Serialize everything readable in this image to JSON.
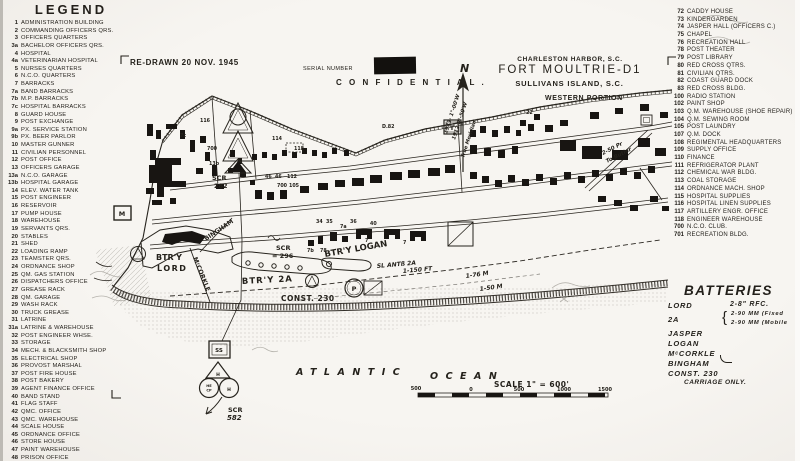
{
  "title_block": {
    "line1": "CHARLESTON HARBOR, S.C.",
    "line2": "FORT MOULTRIE-D1",
    "line3": "SULLIVANS ISLAND, S.C.",
    "line4": "WESTERN PORTION"
  },
  "annotations": {
    "redrawn": "RE-DRAWN 20 NOV. 1945",
    "serial": "SERIAL NUMBER",
    "confidential": "C O N F I D E N T I A L ."
  },
  "legend_left": {
    "title": "LEGEND",
    "items": [
      {
        "n": "1",
        "t": "ADMINISTRATION BUILDING"
      },
      {
        "n": "2",
        "t": "COMMANDING OFFICERS QRS."
      },
      {
        "n": "3",
        "t": "OFFICERS QUARTERS"
      },
      {
        "n": "3a",
        "t": "BACHELOR OFFICERS QRS."
      },
      {
        "n": "4",
        "t": "HOSPITAL"
      },
      {
        "n": "4a",
        "t": "VETERINARIAN HOSPITAL"
      },
      {
        "n": "5",
        "t": "NURSES QUARTERS"
      },
      {
        "n": "6",
        "t": "N.C.O. QUARTERS"
      },
      {
        "n": "7",
        "t": "BARRACKS"
      },
      {
        "n": "7a",
        "t": "BAND BARRACKS"
      },
      {
        "n": "7b",
        "t": "M.P. BARRACKS"
      },
      {
        "n": "7c",
        "t": "HOSPITAL BARRACKS"
      },
      {
        "n": "8",
        "t": "GUARD HOUSE"
      },
      {
        "n": "9",
        "t": "POST EXCHANGE"
      },
      {
        "n": "9a",
        "t": "PX. SERVICE STATION"
      },
      {
        "n": "9b",
        "t": "PX. BEER PARLOR"
      },
      {
        "n": "10",
        "t": "MASTER GUNNER"
      },
      {
        "n": "11",
        "t": "CIVILIAN PERSONNEL"
      },
      {
        "n": "12",
        "t": "POST OFFICE"
      },
      {
        "n": "13",
        "t": "OFFICERS GARAGE"
      },
      {
        "n": "13a",
        "t": "N.C.O. GARAGE"
      },
      {
        "n": "13b",
        "t": "HOSPITAL GARAGE"
      },
      {
        "n": "14",
        "t": "ELEV. WATER TANK"
      },
      {
        "n": "15",
        "t": "POST ENGINEER"
      },
      {
        "n": "16",
        "t": "RESERVOIR"
      },
      {
        "n": "17",
        "t": "PUMP HOUSE"
      },
      {
        "n": "18",
        "t": "WAREHOUSE"
      },
      {
        "n": "19",
        "t": "SERVANTS QRS."
      },
      {
        "n": "20",
        "t": "STABLES"
      },
      {
        "n": "21",
        "t": "SHED"
      },
      {
        "n": "22",
        "t": "LOADING RAMP"
      },
      {
        "n": "23",
        "t": "TEAMSTER QRS."
      },
      {
        "n": "24",
        "t": "ORDNANCE SHOP"
      },
      {
        "n": "25",
        "t": "QM. GAS STATION"
      },
      {
        "n": "26",
        "t": "DISPATCHERS OFFICE"
      },
      {
        "n": "27",
        "t": "GREASE RACK"
      },
      {
        "n": "28",
        "t": "QM. GARAGE"
      },
      {
        "n": "29",
        "t": "WASH RACK"
      },
      {
        "n": "30",
        "t": "TRUCK GREASE"
      },
      {
        "n": "31",
        "t": "LATRINE"
      },
      {
        "n": "31a",
        "t": "LATRINE & WAREHOUSE"
      },
      {
        "n": "32",
        "t": "POST ENGINEER WHSE."
      },
      {
        "n": "33",
        "t": "STORAGE"
      },
      {
        "n": "34",
        "t": "MECH. & BLACKSMITH SHOP"
      },
      {
        "n": "35",
        "t": "ELECTRICAL SHOP"
      },
      {
        "n": "36",
        "t": "PROVOST MARSHAL"
      },
      {
        "n": "37",
        "t": "POST FIRE HOUSE"
      },
      {
        "n": "38",
        "t": "POST BAKERY"
      },
      {
        "n": "39",
        "t": "AGENT FINANCE OFFICE"
      },
      {
        "n": "40",
        "t": "BAND STAND"
      },
      {
        "n": "41",
        "t": "FLAG STAFF"
      },
      {
        "n": "42",
        "t": "QMC. OFFICE"
      },
      {
        "n": "43",
        "t": "QMC. WAREHOUSE"
      },
      {
        "n": "44",
        "t": "SCALE HOUSE"
      },
      {
        "n": "45",
        "t": "ORDNANCE OFFICE"
      },
      {
        "n": "46",
        "t": "STORE HOUSE"
      },
      {
        "n": "47",
        "t": "PAINT WAREHOUSE"
      },
      {
        "n": "48",
        "t": "PRISON OFFICE"
      },
      {
        "n": "49",
        "t": "TOOL SHED"
      }
    ]
  },
  "legend_right": {
    "items": [
      {
        "n": "72",
        "t": "CADDY HOUSE"
      },
      {
        "n": "73",
        "t": "KINDERGARDEN"
      },
      {
        "n": "74",
        "t": "JASPER HALL (OFFICERS C.)"
      },
      {
        "n": "75",
        "t": "CHAPEL"
      },
      {
        "n": "76",
        "t": "RECREATION HALL"
      },
      {
        "n": "78",
        "t": "POST THEATER"
      },
      {
        "n": "79",
        "t": "POST LIBRARY"
      },
      {
        "n": "80",
        "t": "RED CROSS QTRS."
      },
      {
        "n": "81",
        "t": "CIVILIAN QTRS."
      },
      {
        "n": "82",
        "t": "COAST GUARD DOCK"
      },
      {
        "n": "83",
        "t": "RED CROSS BLDG."
      },
      {
        "n": "100",
        "t": "RADIO STATION"
      },
      {
        "n": "102",
        "t": "PAINT SHOP"
      },
      {
        "n": "103",
        "t": "Q.M. WAREHOUSE (SHOE REPAIR)"
      },
      {
        "n": "104",
        "t": "Q.M. SEWING ROOM"
      },
      {
        "n": "105",
        "t": "POST LAUNDRY"
      },
      {
        "n": "107",
        "t": "Q.M. DOCK"
      },
      {
        "n": "108",
        "t": "REGIMENTAL HEADQUARTERS"
      },
      {
        "n": "109",
        "t": "SUPPLY OFFICE"
      },
      {
        "n": "110",
        "t": "FINANCE"
      },
      {
        "n": "111",
        "t": "REFRIGERATOR PLANT"
      },
      {
        "n": "112",
        "t": "CHEMICAL WAR BLDG."
      },
      {
        "n": "113",
        "t": "COAL STORAGE"
      },
      {
        "n": "114",
        "t": "ORDNANCE MACH. SHOP"
      },
      {
        "n": "115",
        "t": "HOSPITAL SUPPLIES"
      },
      {
        "n": "116",
        "t": "HOSPITAL LINEN SUPPLIES"
      },
      {
        "n": "117",
        "t": "ARTILLERY ENGR. OFFICE"
      },
      {
        "n": "118",
        "t": "ENGINEER WAREHOUSE"
      },
      {
        "n": "700",
        "t": "N.C.O. CLUB."
      },
      {
        "n": "701",
        "t": "RECREATION BLDG."
      }
    ]
  },
  "batteries": {
    "title": "BATTERIES",
    "lord_name": "LORD",
    "lord_arm": "2-8\" RFC.",
    "b2a_name": "2A",
    "b2a_brace": "{",
    "b2a_arm1": "2-90 MM (Fixed",
    "b2a_arm2": "2-90 MM (Mobile",
    "others": [
      "JASPER",
      "LOGAN",
      "MᶜCORKLE",
      "BINGHAM",
      "CONST. 230"
    ],
    "carriage_note": "CARRIAGE ONLY."
  },
  "map": {
    "labels": [
      {
        "nm": "north-letter",
        "t": "N",
        "x": 460,
        "y": 72,
        "s": 11,
        "i": 1
      },
      {
        "nm": "declination-1943",
        "t": "1943· 1°-00'W",
        "x": 447,
        "y": 134,
        "s": 5.2,
        "r": -72,
        "i": 1
      },
      {
        "nm": "declination-1912",
        "t": "1912 0°-50'W",
        "x": 455,
        "y": 140,
        "s": 5.2,
        "r": -72,
        "i": 1
      },
      {
        "nm": "true-meridian",
        "t": "True Meridian.",
        "x": 464,
        "y": 158,
        "s": 5,
        "r": -72,
        "i": 1
      },
      {
        "nm": "scr-282-l1",
        "t": "SCR",
        "x": 212,
        "y": 180,
        "s": 6.5
      },
      {
        "nm": "scr-282-l2",
        "t": "282",
        "x": 214,
        "y": 188,
        "s": 6.5
      },
      {
        "nm": "btry-lord-l1",
        "t": "BTR'Y",
        "x": 156,
        "y": 260,
        "s": 8
      },
      {
        "nm": "btry-lord-l2",
        "t": "LORD",
        "x": 157,
        "y": 271,
        "s": 8,
        "ls": 1.5
      },
      {
        "nm": "road-mccorkle",
        "t": "MᶜCORKLE",
        "x": 193,
        "y": 258,
        "s": 6.2,
        "r": 68
      },
      {
        "nm": "road-bingham",
        "t": "BINGHAM",
        "x": 206,
        "y": 241,
        "s": 6.2,
        "r": -34
      },
      {
        "nm": "scr-296-l1",
        "t": "SCR",
        "x": 276,
        "y": 250,
        "s": 6.5
      },
      {
        "nm": "scr-296-l2",
        "t": "= 296",
        "x": 272,
        "y": 258,
        "s": 6.5
      },
      {
        "nm": "btry-2a-label",
        "t": "BTR'Y 2A",
        "x": 242,
        "y": 284,
        "s": 8.5,
        "ls": 1,
        "r": -3
      },
      {
        "nm": "btry-logan-label",
        "t": "BTR'Y LOGAN",
        "x": 325,
        "y": 257,
        "s": 8.5,
        "r": -10
      },
      {
        "nm": "sl-ant-2a",
        "t": "SL ANTß 2A",
        "x": 377,
        "y": 268,
        "s": 6,
        "i": 1,
        "r": -5
      },
      {
        "nm": "const-230-label",
        "t": "CONST. 230",
        "x": 281,
        "y": 301,
        "s": 7.5,
        "ls": 0.5
      },
      {
        "nm": "dist-150ft",
        "t": "1-150 FT",
        "x": 403,
        "y": 273,
        "s": 6,
        "i": 1,
        "r": -5
      },
      {
        "nm": "dist-76m",
        "t": "1-76 M",
        "x": 466,
        "y": 278,
        "s": 6,
        "i": 1,
        "r": -8
      },
      {
        "nm": "dist-50m",
        "t": "1-50 M",
        "x": 480,
        "y": 291,
        "s": 6,
        "i": 1,
        "r": -8
      },
      {
        "nm": "butler-l1",
        "t": "2-50 Pr",
        "x": 603,
        "y": 155,
        "s": 5.5,
        "i": 1,
        "r": -27
      },
      {
        "nm": "butler-l2",
        "t": "To Butler",
        "x": 607,
        "y": 163,
        "s": 5.5,
        "i": 1,
        "r": -27
      },
      {
        "nm": "scr-582-l1",
        "t": "SCR",
        "x": 228,
        "y": 412,
        "s": 6.5
      },
      {
        "nm": "scr-582-l2",
        "t": "582",
        "x": 227,
        "y": 420,
        "s": 7,
        "i": 1
      },
      {
        "nm": "symbol-m",
        "t": "M",
        "x": 122,
        "y": 216,
        "s": 6.5,
        "a": 1
      },
      {
        "nm": "symbol-t",
        "t": "T",
        "x": 452,
        "y": 130,
        "s": 6.5,
        "a": 1
      },
      {
        "nm": "symbol-p",
        "t": "P",
        "x": 354,
        "y": 291,
        "s": 6.5,
        "a": 1
      },
      {
        "nm": "symbol-ss",
        "t": "SS",
        "x": 219,
        "y": 352,
        "s": 5.5,
        "a": 1
      },
      {
        "nm": "symbol-h-tri",
        "t": "H",
        "x": 218,
        "y": 376,
        "s": 4.5,
        "a": 1
      },
      {
        "nm": "symbol-he",
        "t": "HE",
        "x": 209,
        "y": 387,
        "s": 3.6,
        "a": 1
      },
      {
        "nm": "symbol-cp",
        "t": "CP",
        "x": 209,
        "y": 391.5,
        "s": 3.6,
        "a": 1
      },
      {
        "nm": "symbol-h2",
        "t": "H",
        "x": 229,
        "y": 391,
        "s": 4.5,
        "a": 1
      },
      {
        "nm": "ocean-word-1",
        "t": "ATLANTIC",
        "x": 296,
        "y": 375,
        "s": 9.5,
        "ls": 7.5,
        "i": 1
      },
      {
        "nm": "ocean-word-2",
        "t": "OCEAN",
        "x": 430,
        "y": 379,
        "s": 9.5,
        "ls": 7.5,
        "i": 1
      },
      {
        "nm": "scale-label",
        "t": "SCALE 1\" = 600'",
        "x": 494,
        "y": 387,
        "s": 7.5,
        "ls": 0.5
      },
      {
        "nm": "scale-tick",
        "t": "500",
        "x": 416,
        "y": 390,
        "s": 5,
        "a": 1
      },
      {
        "nm": "scale-tick",
        "t": "0",
        "x": 471,
        "y": 391,
        "s": 5,
        "a": 1
      },
      {
        "nm": "scale-tick",
        "t": "500",
        "x": 519,
        "y": 391,
        "s": 5,
        "a": 1
      },
      {
        "nm": "scale-tick",
        "t": "1000",
        "x": 564,
        "y": 391,
        "s": 5,
        "a": 1
      },
      {
        "nm": "scale-tick",
        "t": "1500",
        "x": 605,
        "y": 391,
        "s": 5,
        "a": 1
      }
    ],
    "markers": [
      {
        "t": "116",
        "x": 200,
        "y": 122
      },
      {
        "t": "7c",
        "x": 180,
        "y": 137
      },
      {
        "t": "700",
        "x": 207,
        "y": 150
      },
      {
        "t": "13b",
        "x": 209,
        "y": 165
      },
      {
        "t": "114",
        "x": 272,
        "y": 140
      },
      {
        "t": "118",
        "x": 294,
        "y": 150
      },
      {
        "t": "46",
        "x": 265,
        "y": 178
      },
      {
        "t": "46",
        "x": 275,
        "y": 178
      },
      {
        "t": "112",
        "x": 287,
        "y": 178
      },
      {
        "t": "700",
        "x": 277,
        "y": 187
      },
      {
        "t": "105",
        "x": 289,
        "y": 187
      },
      {
        "t": "34",
        "x": 316,
        "y": 223
      },
      {
        "t": "35",
        "x": 326,
        "y": 223
      },
      {
        "t": "36",
        "x": 350,
        "y": 223
      },
      {
        "t": "40",
        "x": 370,
        "y": 225
      },
      {
        "t": "7a",
        "x": 340,
        "y": 228
      },
      {
        "t": "7",
        "x": 365,
        "y": 242
      },
      {
        "t": "7",
        "x": 403,
        "y": 244
      },
      {
        "t": "7b",
        "x": 307,
        "y": 252
      },
      {
        "t": "78",
        "x": 320,
        "y": 252
      },
      {
        "t": "22",
        "x": 526,
        "y": 114
      },
      {
        "t": "D.82",
        "x": 382,
        "y": 128
      }
    ]
  }
}
